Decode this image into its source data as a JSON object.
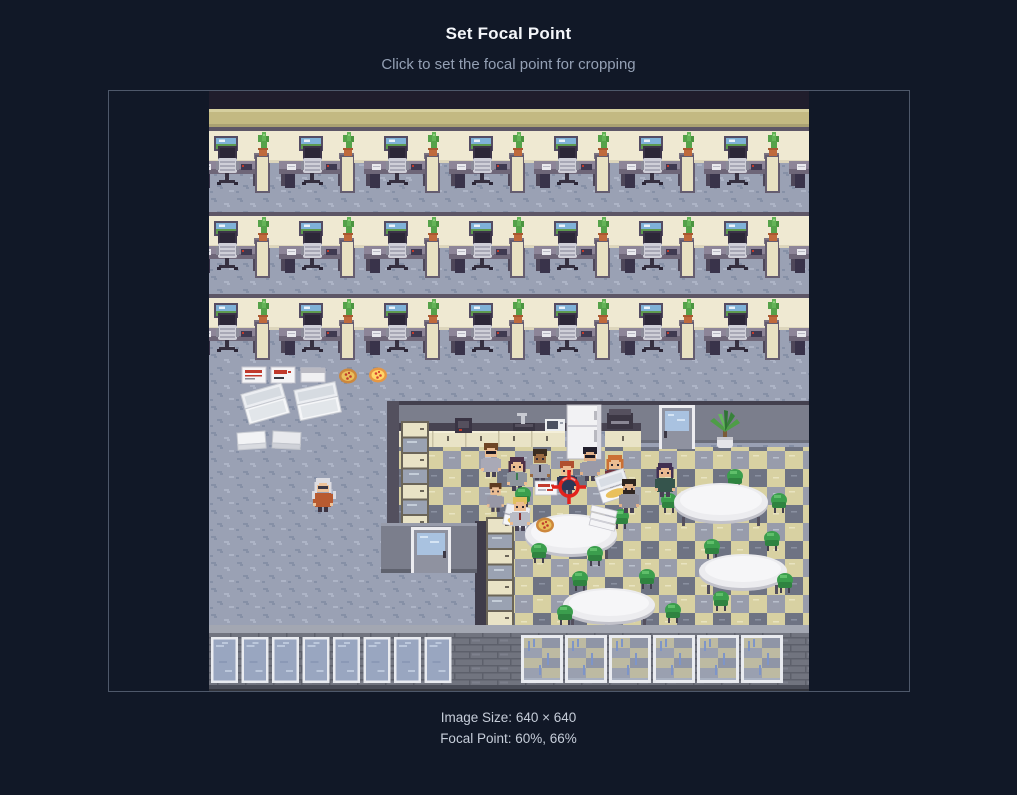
{
  "header": {
    "title": "Set Focal Point",
    "subtitle": "Click to set the focal point for cropping"
  },
  "cropper": {
    "image": {
      "description": "Pixel-art office floor map: three rows of cubicles with desks, monitors and chairs; scattered pizza boxes and menus; a break room with checkered floor, kitchen counter, fridge, round tables, green chairs and people sharing pizza; window wall along the bottom",
      "natural_width": 640,
      "natural_height": 640,
      "display_width": 600,
      "display_height": 600
    },
    "focal_point": {
      "x_percent": 60,
      "y_percent": 66,
      "marker_color": "#e3221c"
    }
  },
  "footer": {
    "image_size_label": "Image Size:",
    "image_size_value": "640 × 640",
    "focal_point_label": "Focal Point:",
    "focal_point_value": "60%, 66%"
  },
  "colors": {
    "page_background": "#111827",
    "frame_border": "#4e586a",
    "marker_red": "#e3221c",
    "carpet": "#9aa1b4",
    "checker_khaki": "#d8d1a2",
    "checker_gray": "#989cab"
  }
}
